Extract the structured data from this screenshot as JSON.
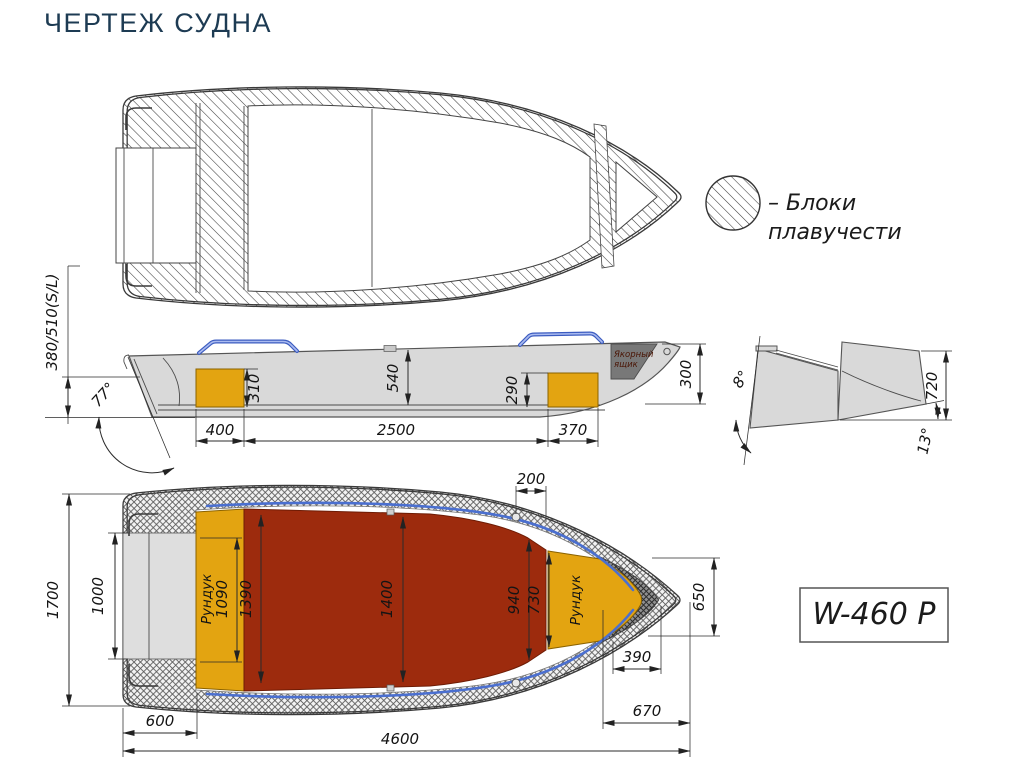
{
  "title": "ЧЕРТЕЖ СУДНА",
  "legend": {
    "line1": "– Блоки",
    "line2": "плавучести"
  },
  "badge": {
    "model": "W-460 P"
  },
  "side_view": {
    "freeboard": "380/510(S/L)",
    "transom_angle": "77°",
    "aft_locker_height": "310",
    "cockpit_depth": "540",
    "bow_locker_height": "290",
    "bow_height": "300",
    "aft_locker_length": "400",
    "cockpit_length": "2500",
    "bow_locker_length": "370",
    "anchor_box_line1": "Якорный",
    "anchor_box_line2": "ящик"
  },
  "transom_view": {
    "flare_angle": "8°",
    "height": "720",
    "deadrise_angle": "13°"
  },
  "plan_view": {
    "beam": "1700",
    "transom_inner_width": "1000",
    "aft_locker_label": "Рундук",
    "aft_locker_width": "1090",
    "floor_width_aft": "1390",
    "floor_width_mid": "1400",
    "floor_width_fwd": "940",
    "bow_locker_width": "730",
    "bow_locker_label": "Рундук",
    "gunwale_gap": "200",
    "bow_section_length": "650",
    "bow_locker_length": "390",
    "bow_length": "670",
    "stern_section_length": "600",
    "overall_length": "4600"
  },
  "colors": {
    "title_navy": "#1d3b53",
    "hull_gray": "#d9d9d9",
    "floor_red": "#9d2b0d",
    "locker_yellow": "#e3a411",
    "handle_blue": "#4a6fd0",
    "anchor_gray": "#787878"
  }
}
